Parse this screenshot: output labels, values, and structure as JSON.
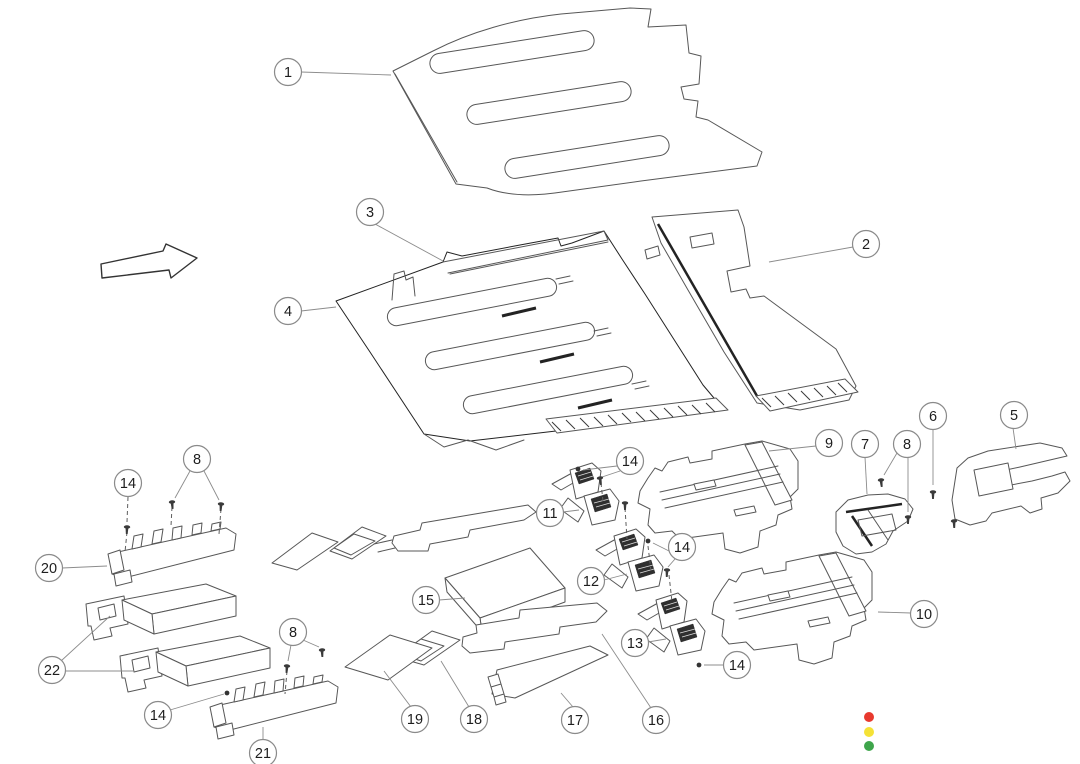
{
  "diagram": {
    "type": "exploded-view-parts-diagram",
    "callouts": [
      {
        "label": "1",
        "x": 288,
        "y": 72
      },
      {
        "label": "3",
        "x": 370,
        "y": 212
      },
      {
        "label": "4",
        "x": 288,
        "y": 311
      },
      {
        "label": "2",
        "x": 866,
        "y": 244
      },
      {
        "label": "5",
        "x": 1014,
        "y": 415
      },
      {
        "label": "6",
        "x": 933,
        "y": 416
      },
      {
        "label": "9",
        "x": 829,
        "y": 443
      },
      {
        "label": "7",
        "x": 865,
        "y": 444
      },
      {
        "label": "8",
        "x": 907,
        "y": 444
      },
      {
        "label": "8",
        "x": 197,
        "y": 459
      },
      {
        "label": "14",
        "x": 128,
        "y": 483
      },
      {
        "label": "14",
        "x": 630,
        "y": 461
      },
      {
        "label": "11",
        "x": 550,
        "y": 513
      },
      {
        "label": "14",
        "x": 682,
        "y": 547
      },
      {
        "label": "20",
        "x": 49,
        "y": 568
      },
      {
        "label": "12",
        "x": 591,
        "y": 581
      },
      {
        "label": "15",
        "x": 426,
        "y": 600
      },
      {
        "label": "10",
        "x": 924,
        "y": 614
      },
      {
        "label": "8",
        "x": 293,
        "y": 632
      },
      {
        "label": "13",
        "x": 635,
        "y": 643
      },
      {
        "label": "14",
        "x": 737,
        "y": 665
      },
      {
        "label": "22",
        "x": 52,
        "y": 670
      },
      {
        "label": "14",
        "x": 158,
        "y": 715
      },
      {
        "label": "19",
        "x": 415,
        "y": 719
      },
      {
        "label": "18",
        "x": 474,
        "y": 719
      },
      {
        "label": "17",
        "x": 575,
        "y": 720
      },
      {
        "label": "16",
        "x": 656,
        "y": 720
      },
      {
        "label": "21",
        "x": 263,
        "y": 753
      }
    ],
    "leader_lines": [
      [
        301,
        72,
        391,
        75
      ],
      [
        375,
        224,
        443,
        261
      ],
      [
        301,
        311,
        336,
        307
      ],
      [
        853,
        247,
        769,
        262
      ],
      [
        1013,
        428,
        1016,
        449
      ],
      [
        933,
        429,
        933,
        485
      ],
      [
        816,
        446,
        769,
        451
      ],
      [
        865,
        457,
        867,
        494
      ],
      [
        897,
        453,
        884,
        475
      ],
      [
        908,
        457,
        908,
        512
      ],
      [
        190,
        471,
        175,
        498
      ],
      [
        204,
        471,
        219,
        500
      ],
      [
        617,
        466,
        583,
        470
      ],
      [
        620,
        471,
        602,
        477
      ],
      [
        563,
        512,
        579,
        510
      ],
      [
        669,
        551,
        653,
        543
      ],
      [
        675,
        559,
        668,
        567
      ],
      [
        62,
        568,
        107,
        566
      ],
      [
        604,
        580,
        627,
        574
      ],
      [
        439,
        600,
        465,
        598
      ],
      [
        911,
        613,
        878,
        612
      ],
      [
        303,
        640,
        319,
        647
      ],
      [
        291,
        645,
        288,
        661
      ],
      [
        648,
        642,
        666,
        639
      ],
      [
        724,
        665,
        704,
        665
      ],
      [
        61,
        661,
        110,
        616
      ],
      [
        65,
        671,
        133,
        671
      ],
      [
        170,
        710,
        224,
        694
      ],
      [
        411,
        707,
        384,
        671
      ],
      [
        469,
        707,
        441,
        661
      ],
      [
        573,
        707,
        561,
        693
      ],
      [
        651,
        708,
        602,
        634
      ],
      [
        263,
        740,
        263,
        727
      ]
    ],
    "dashed_lines": [
      [
        128,
        497,
        127,
        522
      ],
      [
        127,
        532,
        125,
        552
      ],
      [
        172,
        507,
        171,
        526
      ],
      [
        221,
        509,
        219,
        534
      ],
      [
        287,
        671,
        285,
        694
      ],
      [
        601,
        483,
        603,
        501
      ],
      [
        625,
        508,
        627,
        539
      ],
      [
        648,
        546,
        651,
        571
      ],
      [
        669,
        575,
        672,
        602
      ]
    ],
    "fasteners": {
      "screws_side": [
        [
          127,
          527,
          2
        ],
        [
          172,
          502,
          -5
        ],
        [
          221,
          504,
          3
        ],
        [
          287,
          666,
          4
        ],
        [
          322,
          650,
          -3
        ],
        [
          600,
          478,
          -8
        ],
        [
          625,
          503,
          0
        ],
        [
          667,
          570,
          2
        ],
        [
          881,
          480,
          -6
        ],
        [
          908,
          517,
          0
        ],
        [
          933,
          492,
          0
        ],
        [
          954,
          521,
          -2
        ]
      ],
      "screws_top": [
        [
          578,
          469
        ],
        [
          648,
          541
        ],
        [
          699,
          665
        ],
        [
          227,
          693
        ]
      ]
    },
    "status_dots": {
      "x": 869,
      "radius": 5,
      "items": [
        {
          "name": "red-dot",
          "color": "#e8392e",
          "y": 717
        },
        {
          "name": "yellow-dot",
          "color": "#f5e236",
          "y": 732
        },
        {
          "name": "green-dot",
          "color": "#3ea54b",
          "y": 746
        }
      ]
    }
  }
}
